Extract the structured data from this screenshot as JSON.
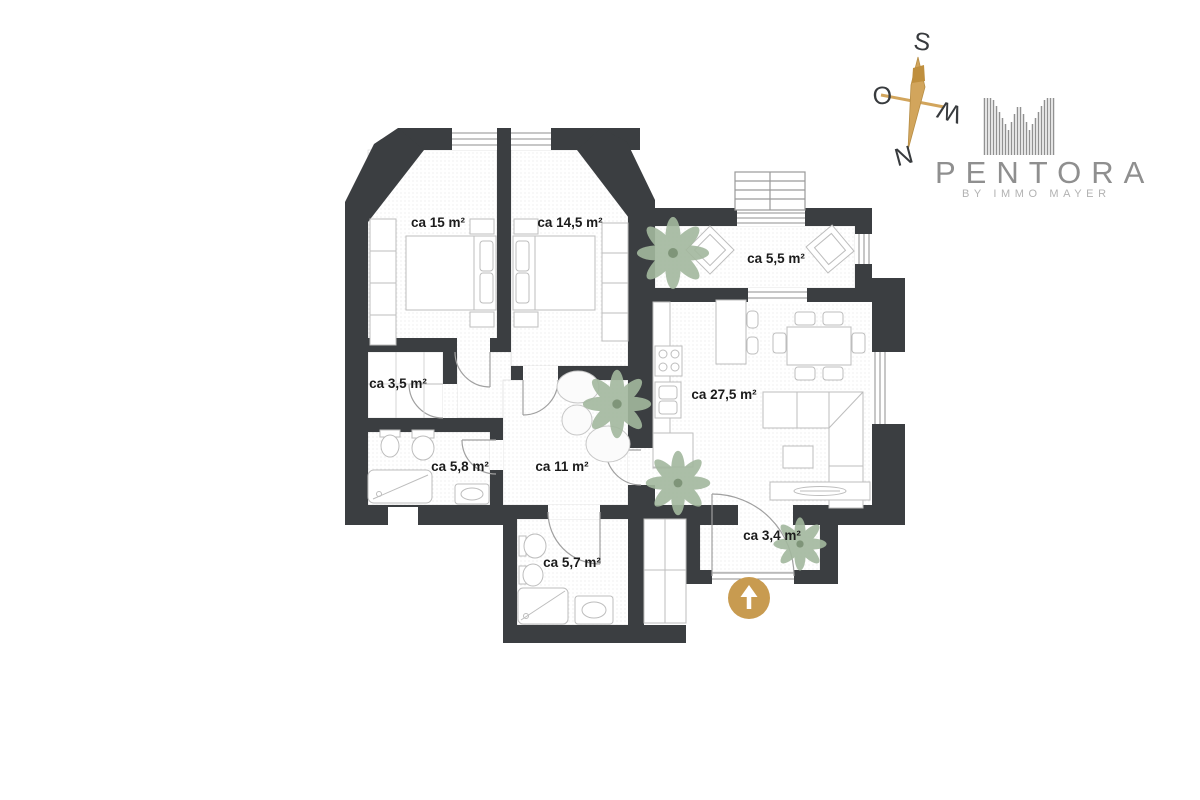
{
  "brand": {
    "name": "PENTORA",
    "tagline": "BY IMMO MAYER"
  },
  "compass": {
    "top": "S",
    "left": "O",
    "right": "W",
    "bottom": "N"
  },
  "floorplan": {
    "rooms": [
      {
        "id": "bedroom-1",
        "label": "ca 15 m²"
      },
      {
        "id": "bedroom-2",
        "label": "ca 14,5 m²"
      },
      {
        "id": "balcony",
        "label": "ca 5,5 m²"
      },
      {
        "id": "storage",
        "label": "ca 3,5 m²"
      },
      {
        "id": "living-room-kitchen",
        "label": "ca 27,5 m²"
      },
      {
        "id": "bathroom",
        "label": "ca 5,8 m²"
      },
      {
        "id": "hallway",
        "label": "ca 11 m²"
      },
      {
        "id": "shower-room",
        "label": "ca 5,7 m²"
      },
      {
        "id": "entry",
        "label": "ca 3,4 m²"
      }
    ],
    "entrance_marker": "up-arrow"
  },
  "colors": {
    "wall": "#3b3e41",
    "accent_gold": "#c89b50",
    "brand_gray": "#8f8f8f",
    "plant_green": "#9fb69b"
  }
}
